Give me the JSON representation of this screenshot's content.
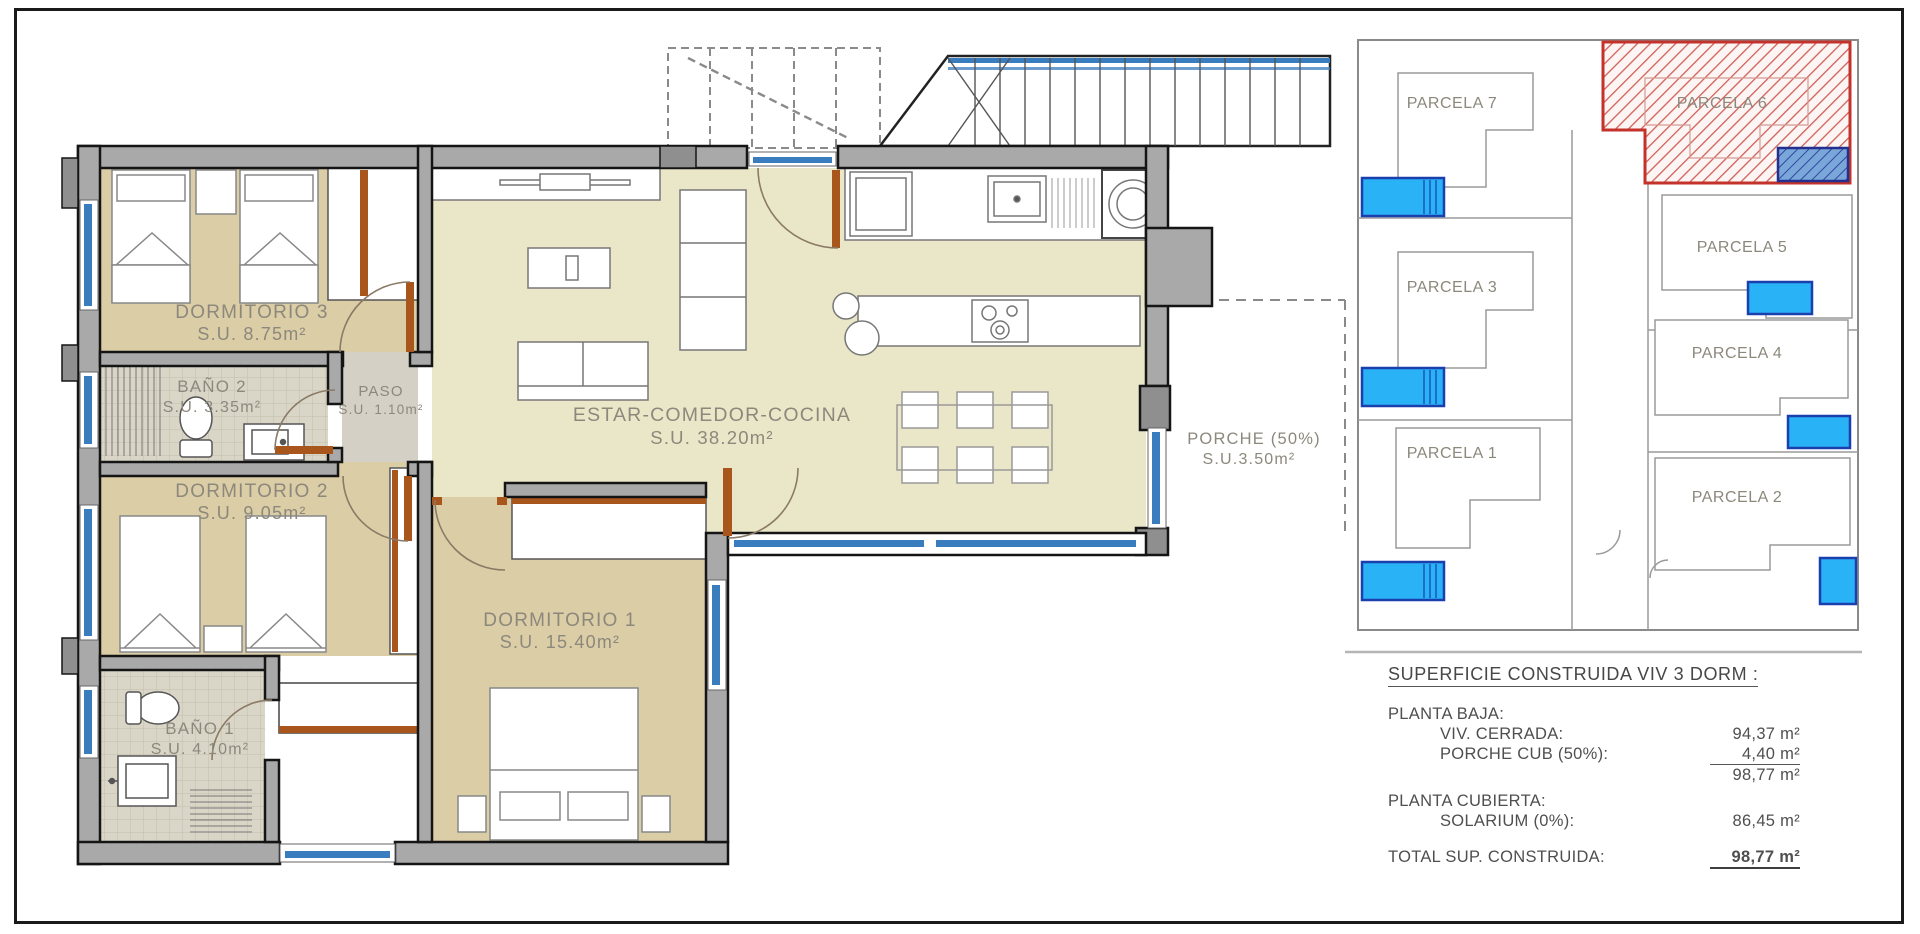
{
  "floor_plan": {
    "rooms": {
      "dormitorio3": {
        "name": "DORMITORIO 3",
        "area": "S.U. 8.75m²"
      },
      "bano2": {
        "name": "BAÑO 2",
        "area": "S.U. 3.35m²"
      },
      "paso": {
        "name": "PASO",
        "area": "S.U. 1.10m²"
      },
      "dormitorio2": {
        "name": "DORMITORIO 2",
        "area": "S.U. 9.05m²"
      },
      "estar": {
        "name": "ESTAR-COMEDOR-COCINA",
        "area": "S.U. 38.20m²"
      },
      "dormitorio1": {
        "name": "DORMITORIO 1",
        "area": "S.U. 15.40m²"
      },
      "bano1": {
        "name": "BAÑO 1",
        "area": "S.U. 4.10m²"
      },
      "porche": {
        "name": "PORCHE (50%)",
        "area": "S.U.3.50m²"
      }
    },
    "colors": {
      "bedroom_tan": "#dbcda6",
      "living_beige": "#eae7c9",
      "window_blue": "#3a7dbf",
      "door_brown": "#a9561c",
      "wall_gray": "#a9a9a9"
    }
  },
  "site_plan": {
    "parcels": {
      "p1": "PARCELA 1",
      "p2": "PARCELA 2",
      "p3": "PARCELA 3",
      "p4": "PARCELA 4",
      "p5": "PARCELA 5",
      "p6": "PARCELA 6",
      "p7": "PARCELA 7"
    },
    "highlighted_parcel": "PARCELA 6",
    "colors": {
      "highlight_red": "#c3332b",
      "pool_blue": "#29b2f5",
      "highlight_pool_blue": "#7aa7d9"
    }
  },
  "summary": {
    "title": "SUPERFICIE CONSTRUIDA VIV 3 DORM :",
    "planta_baja_label": "PLANTA BAJA:",
    "viv_cerrada_label": "VIV. CERRADA:",
    "viv_cerrada_value": "94,37 m²",
    "porche_cub_label": "PORCHE CUB (50%):",
    "porche_cub_value": "4,40 m²",
    "planta_baja_subtotal": "98,77 m²",
    "planta_cubierta_label": "PLANTA CUBIERTA:",
    "solarium_label": "SOLARIUM (0%):",
    "solarium_value": "86,45 m²",
    "total_label": "TOTAL SUP. CONSTRUIDA:",
    "total_value": "98,77 m²"
  }
}
